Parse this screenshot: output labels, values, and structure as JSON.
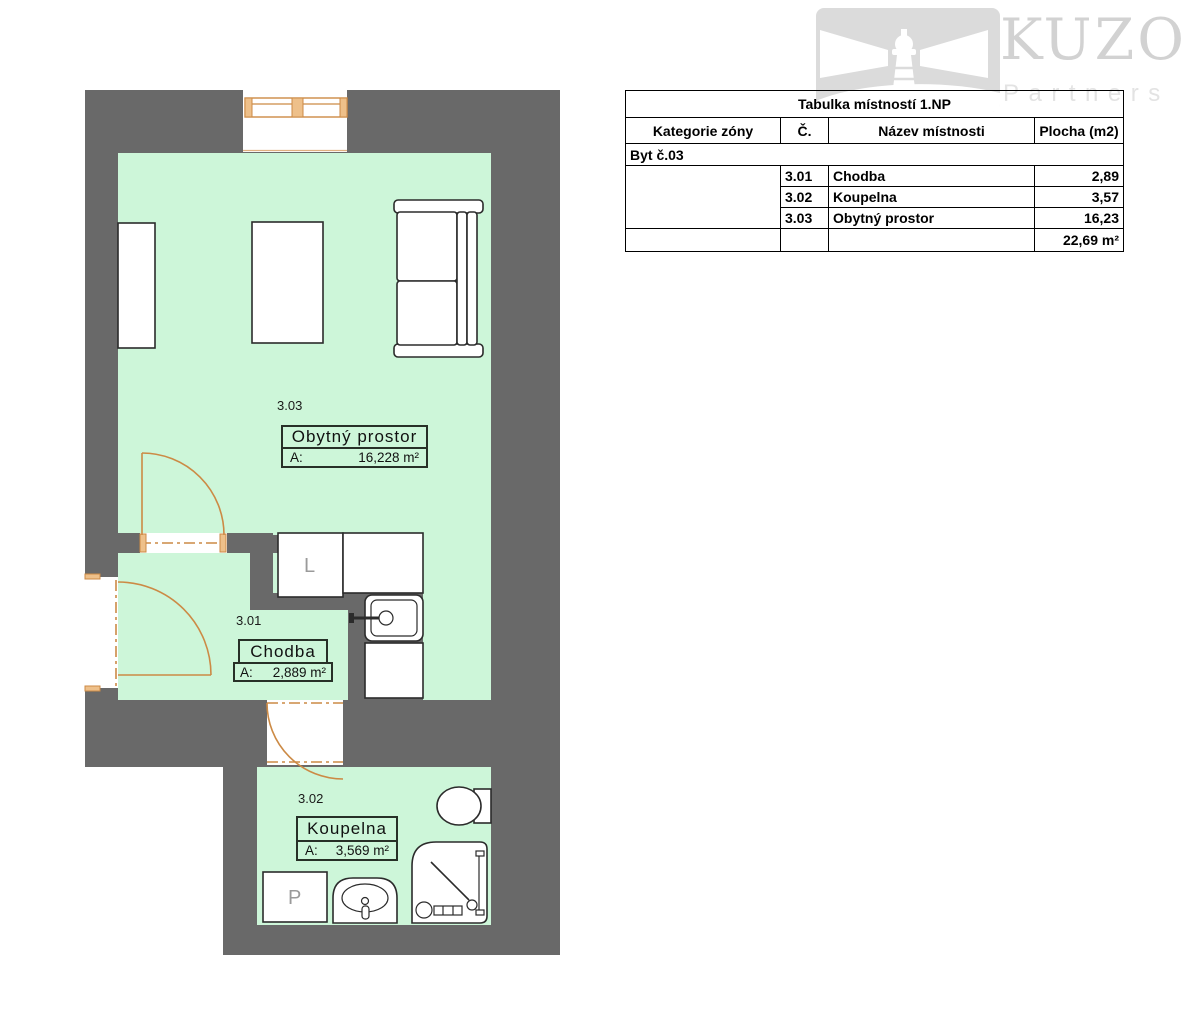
{
  "logo": {
    "brand": "KUZO",
    "subtitle": "Partners"
  },
  "room_table": {
    "title": "Tabulka místností 1.NP",
    "headers": {
      "category": "Kategorie zóny",
      "number": "Č.",
      "name": "Název místnosti",
      "area": "Plocha (m2)"
    },
    "group_label": "Byt č.03",
    "rows": [
      {
        "number": "3.01",
        "name": "Chodba",
        "area": "2,89"
      },
      {
        "number": "3.02",
        "name": "Koupelna",
        "area": "3,57"
      },
      {
        "number": "3.03",
        "name": "Obytný prostor",
        "area": "16,23"
      }
    ],
    "total_area": "22,69 m²"
  },
  "plan": {
    "rooms": [
      {
        "id": "3.03",
        "name": "Obytný prostor",
        "area_prefix": "A:",
        "area_value": "16,228 m²"
      },
      {
        "id": "3.01",
        "name": "Chodba",
        "area_prefix": "A:",
        "area_value": "2,889 m²"
      },
      {
        "id": "3.02",
        "name": "Koupelna",
        "area_prefix": "A:",
        "area_value": "3,569 m²"
      }
    ],
    "labels": {
      "fridge": "L",
      "washer": "P"
    },
    "colors": {
      "wall": "#696969",
      "room_fill": "#cdf6d9",
      "joinery": "#cc8a45"
    }
  }
}
